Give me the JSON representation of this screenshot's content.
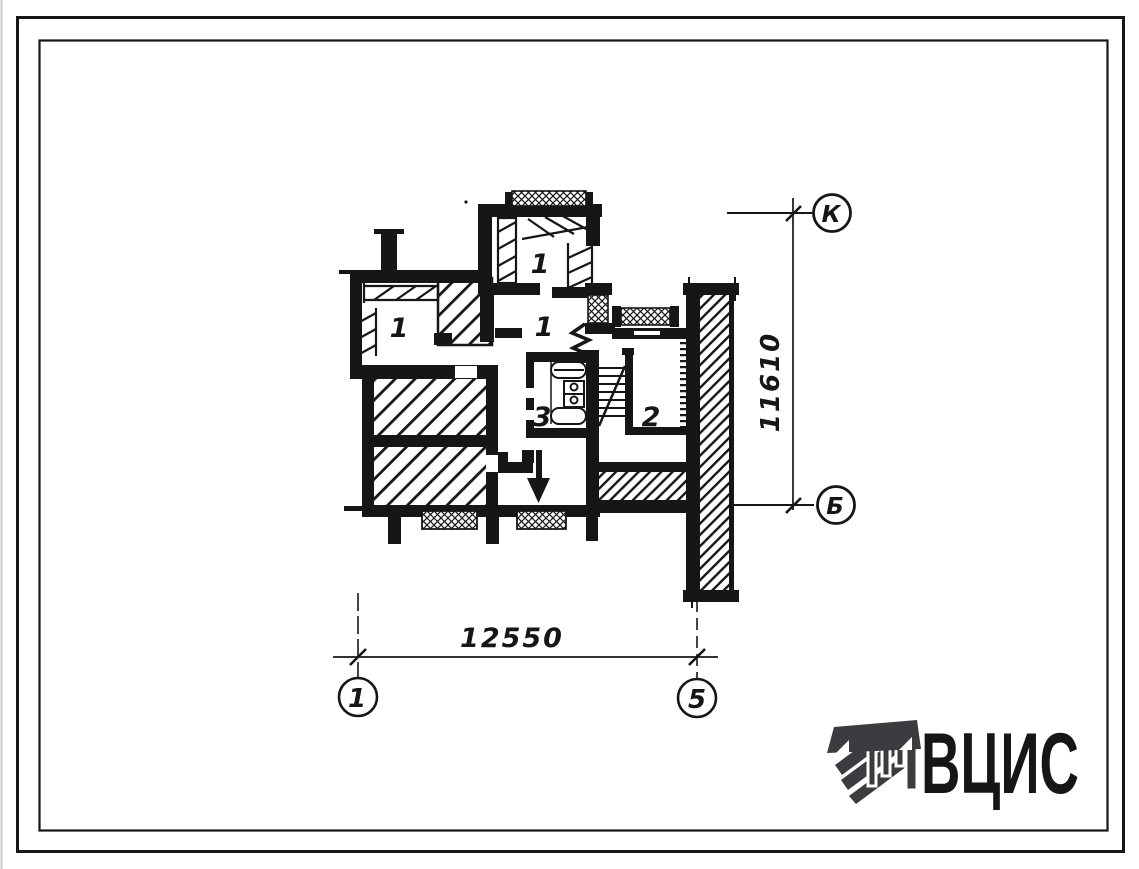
{
  "plan": {
    "room_labels": [
      {
        "room": "top-room",
        "text": "1"
      },
      {
        "room": "hall",
        "text": "1"
      },
      {
        "room": "left-room",
        "text": "1"
      },
      {
        "room": "bathroom",
        "text": "3"
      },
      {
        "room": "stair-room",
        "text": "2"
      }
    ]
  },
  "dimensions": {
    "horizontal_mm": "12550",
    "vertical_mm": "11610"
  },
  "grid_axes": {
    "bottom_left": "1",
    "bottom_right": "5",
    "right_top": "К",
    "right_bottom": "Б"
  },
  "logo": {
    "text": "ВЦИС",
    "icon": "striped-column-icon",
    "color": "#3b3b40"
  },
  "colors": {
    "ink": "#161616",
    "paper": "#ffffff"
  }
}
